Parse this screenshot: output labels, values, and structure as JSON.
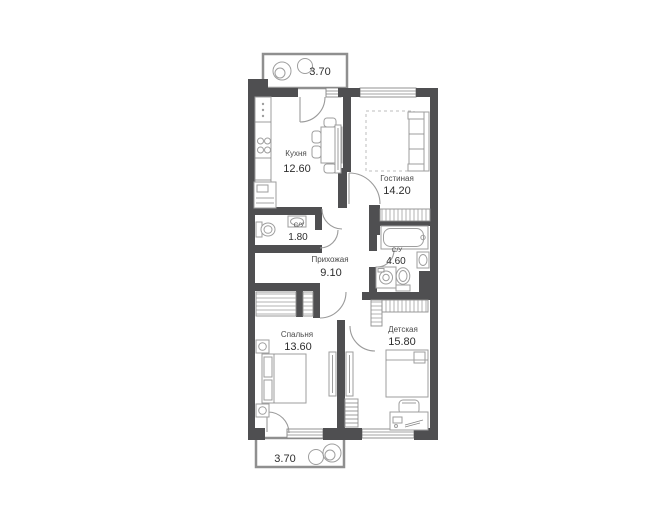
{
  "floor_plan": {
    "rooms": [
      {
        "id": "kitchen",
        "name": "Кухня",
        "area": "12.60"
      },
      {
        "id": "living",
        "name": "Гостиная",
        "area": "14.20"
      },
      {
        "id": "bath-small",
        "name": "С/У",
        "area": "1.80"
      },
      {
        "id": "hallway",
        "name": "Прихожая",
        "area": "9.10"
      },
      {
        "id": "bath-large",
        "name": "С/У",
        "area": "4.60"
      },
      {
        "id": "bedroom",
        "name": "Спальня",
        "area": "13.60"
      },
      {
        "id": "children",
        "name": "Детская",
        "area": "15.80"
      }
    ],
    "balconies": [
      {
        "id": "balcony-top",
        "area": "3.70"
      },
      {
        "id": "balcony-bottom",
        "area": "3.70"
      }
    ],
    "colors": {
      "wall": "#4f4f51",
      "furniture_outline": "#9e9e9e",
      "label_text": "#2e2e2e",
      "background": "#ffffff"
    }
  }
}
